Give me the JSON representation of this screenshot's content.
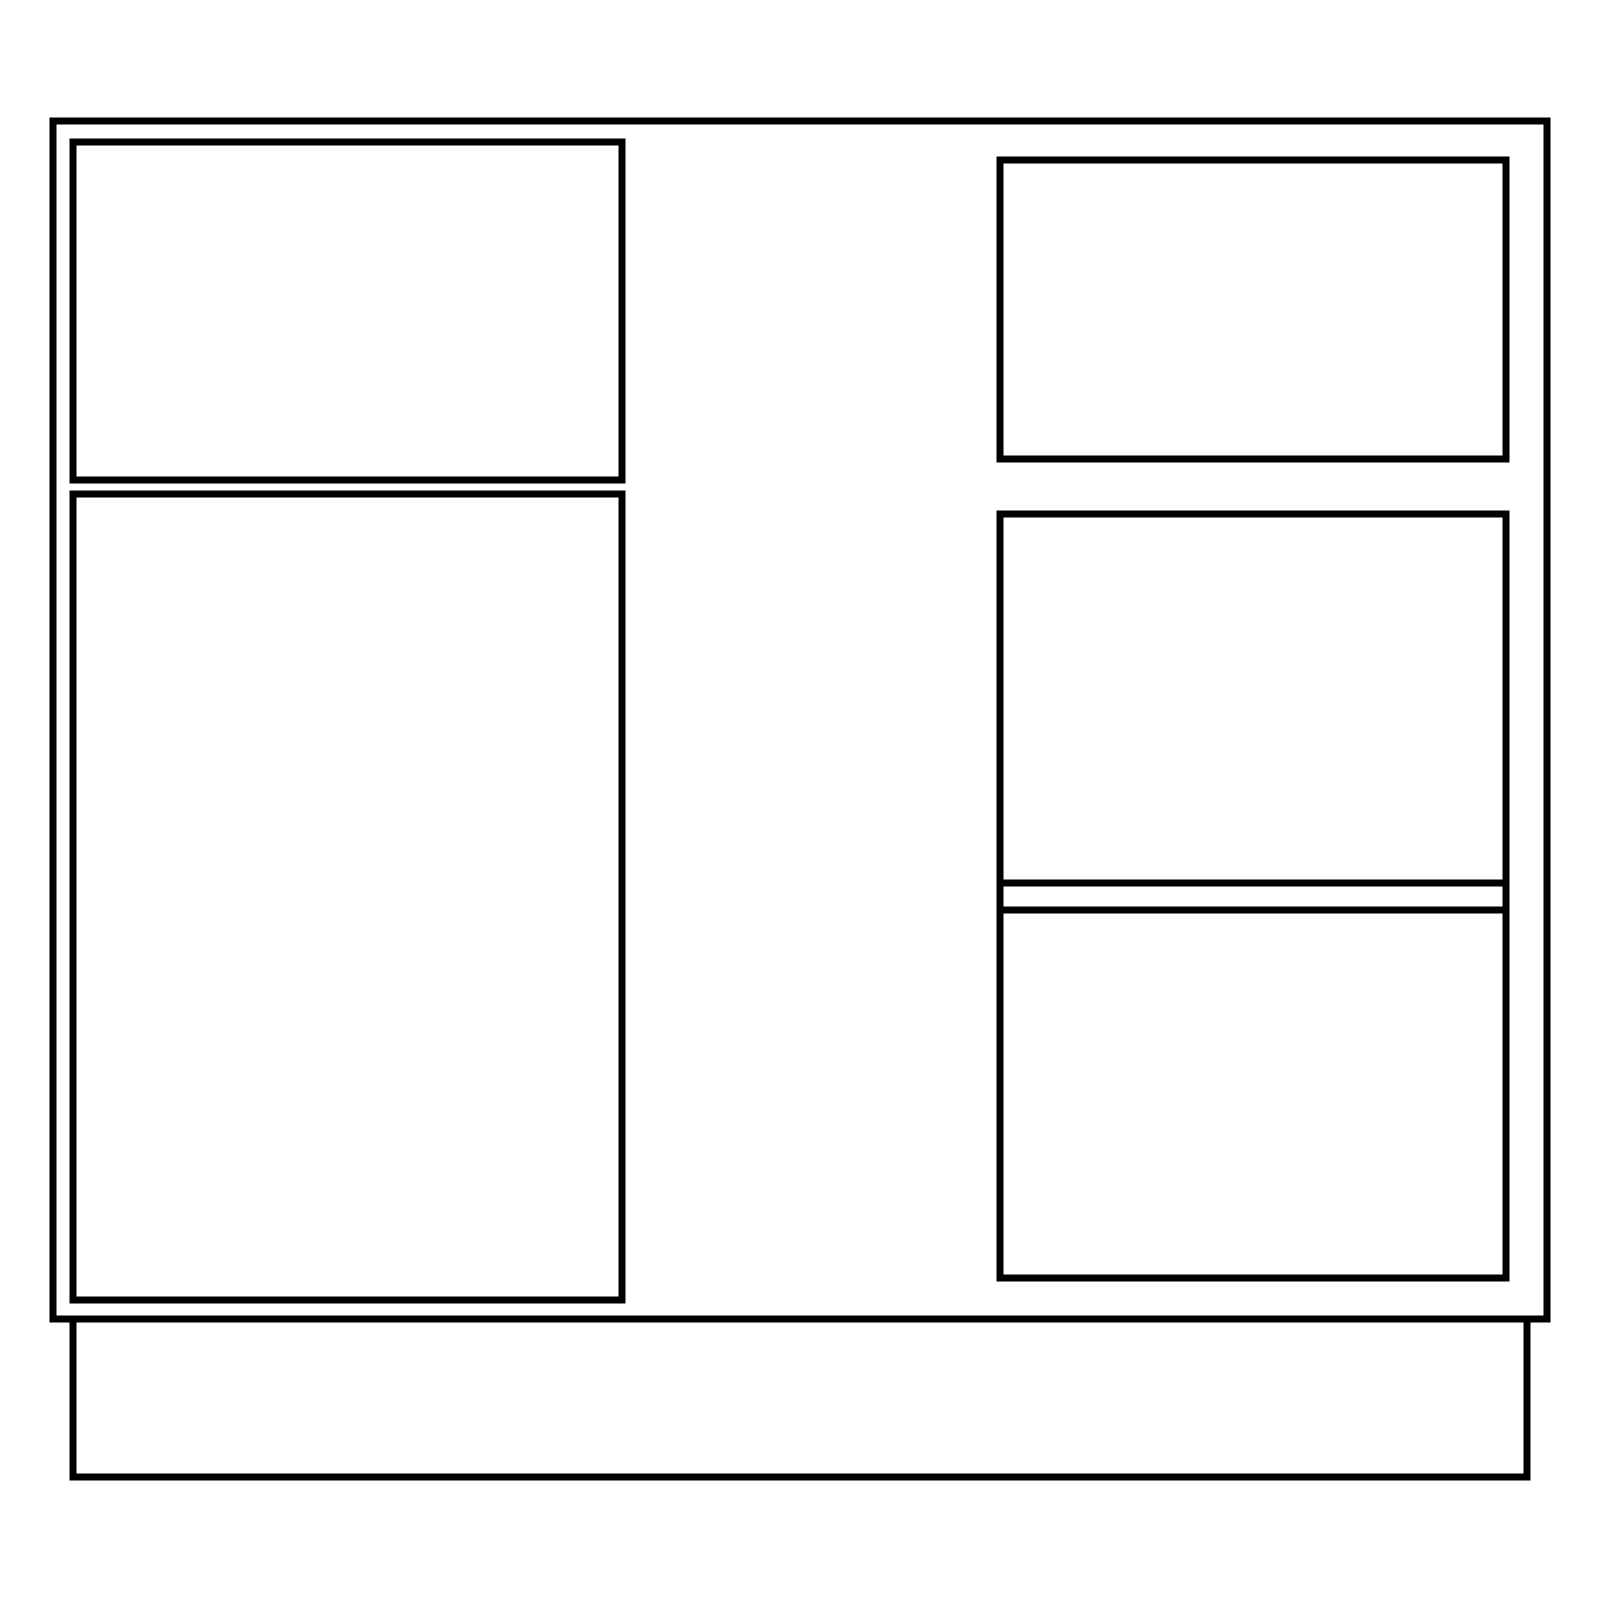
{
  "canvas": {
    "width": 1600,
    "height": 1600,
    "background_color": "#ffffff"
  },
  "drawing": {
    "description": "cabinet-front-elevation-line-drawing",
    "stroke_color": "#000000",
    "stroke_width": 7,
    "fill": "none",
    "shapes": [
      {
        "name": "cabinet-outline",
        "type": "rect",
        "x": 53,
        "y": 121,
        "width": 1494,
        "height": 1198
      },
      {
        "name": "left-top-drawer-front",
        "type": "rect",
        "x": 73,
        "y": 142,
        "width": 549,
        "height": 338
      },
      {
        "name": "left-door-panel",
        "type": "rect",
        "x": 73,
        "y": 494,
        "width": 549,
        "height": 806
      },
      {
        "name": "right-top-drawer-front",
        "type": "rect",
        "x": 1000,
        "y": 160,
        "width": 506,
        "height": 299
      },
      {
        "name": "right-lower-panel",
        "type": "rect",
        "x": 1000,
        "y": 514,
        "width": 506,
        "height": 764
      },
      {
        "name": "right-panel-divider-upper",
        "type": "line",
        "x1": 1000,
        "y1": 883,
        "x2": 1506,
        "y2": 883
      },
      {
        "name": "right-panel-divider-lower",
        "type": "line",
        "x1": 1000,
        "y1": 910,
        "x2": 1506,
        "y2": 910
      },
      {
        "name": "plinth-base",
        "type": "rect",
        "x": 73,
        "y": 1319,
        "width": 1454,
        "height": 158
      }
    ]
  }
}
